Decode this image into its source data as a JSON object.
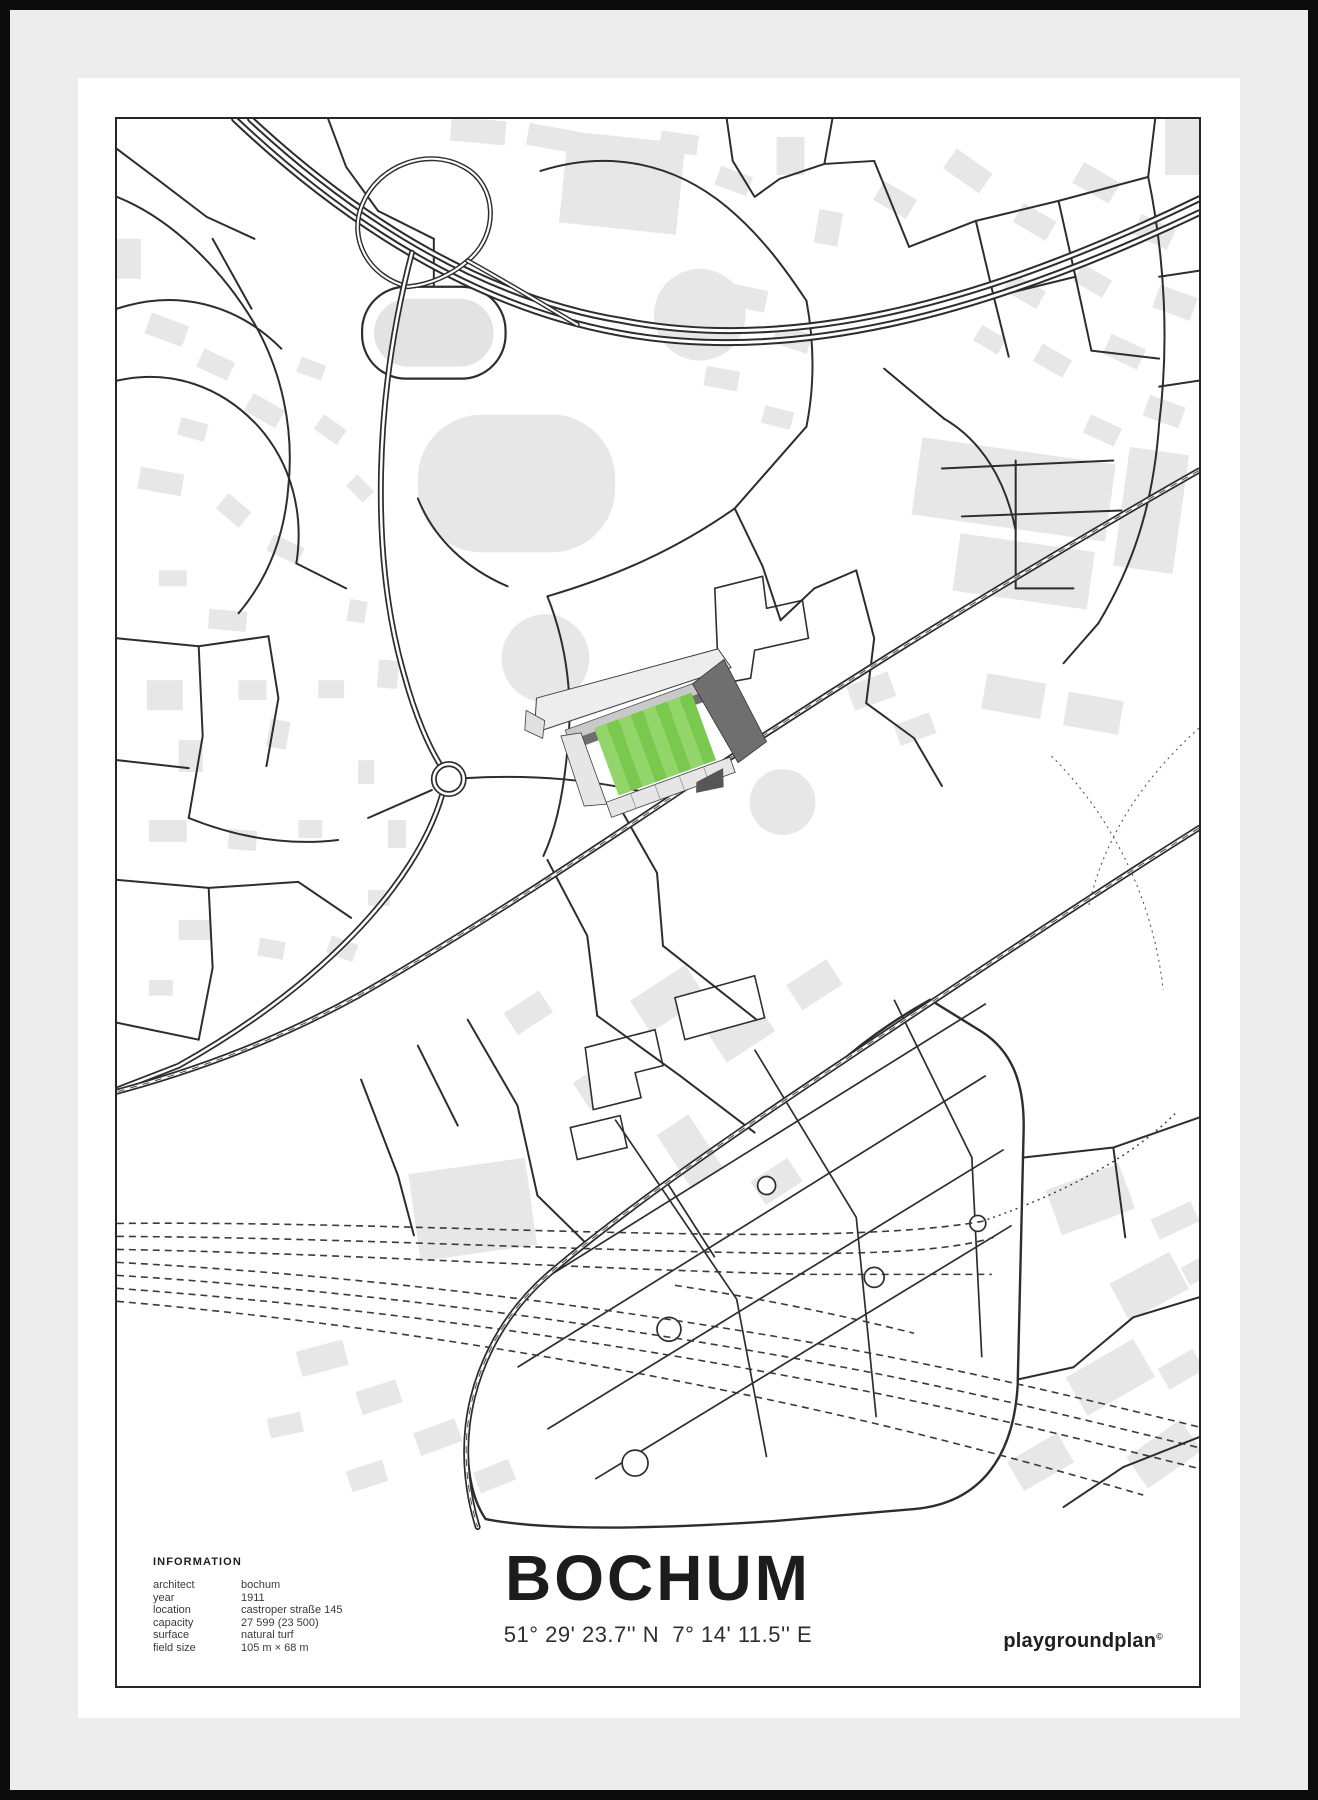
{
  "poster": {
    "title": "BOCHUM",
    "coordinates": "51° 29' 23.7'' N  7° 14' 11.5'' E",
    "brand": {
      "text": "playgroundplan",
      "mark": "©"
    }
  },
  "information": {
    "heading": "INFORMATION",
    "rows": [
      {
        "label": "architect",
        "value": "bochum"
      },
      {
        "label": "year",
        "value": "1911"
      },
      {
        "label": "location",
        "value": "castroper straße 145"
      },
      {
        "label": "capacity",
        "value": "27 599 (23 500)"
      },
      {
        "label": "surface",
        "value": "natural turf"
      },
      {
        "label": "field size",
        "value": "105 m × 68 m"
      }
    ]
  },
  "map": {
    "road_color": "#2d2d2d",
    "building_color": "#e7e7e7",
    "background": "#ffffff",
    "rail_color": "#3a3a3a",
    "stadium": {
      "pitch_stripe_light": "#92d56a",
      "pitch_stripe_dark": "#7bc84e",
      "stand_light": "#e6e6e6",
      "stand_mid": "#c9c9c9",
      "stand_dark": "#6f6f6f"
    }
  },
  "frame": {
    "frame_color": "#0c0c0c",
    "mat_color": "#ededed",
    "border_color": "#262626",
    "sheet_color": "#ffffff"
  }
}
